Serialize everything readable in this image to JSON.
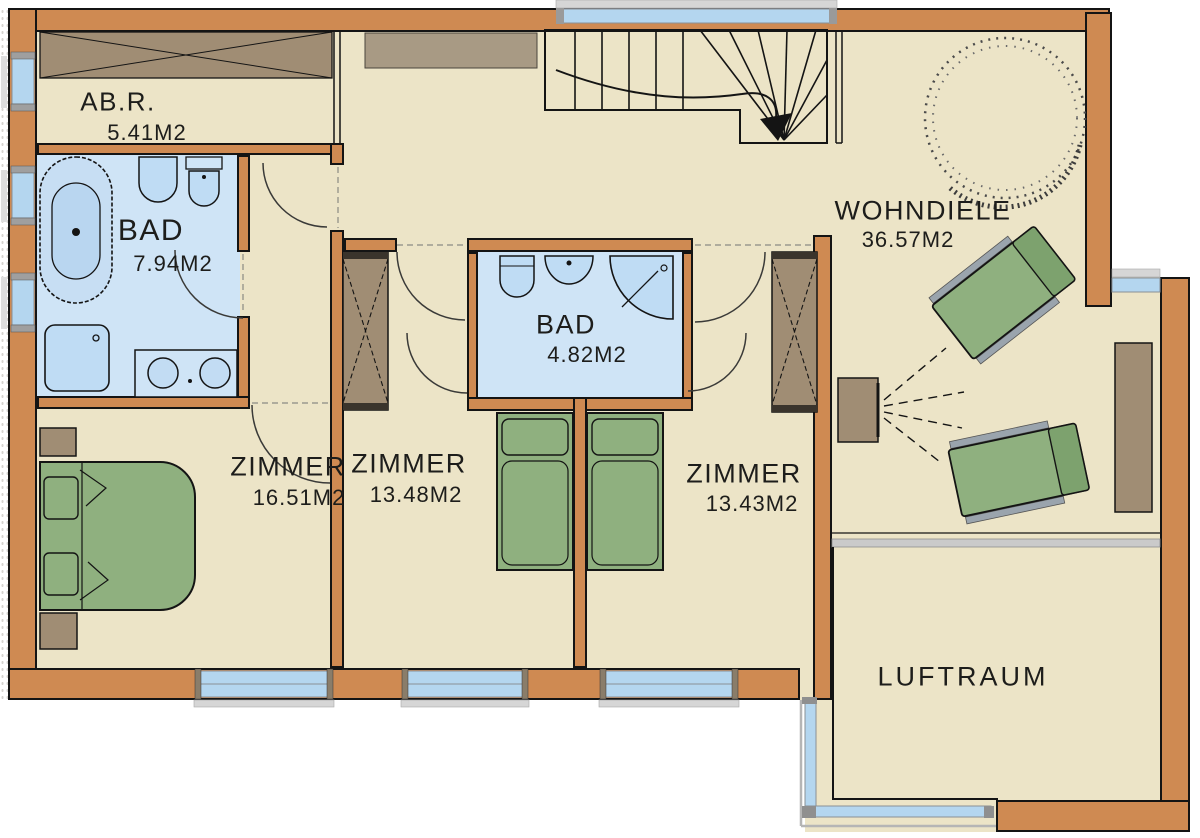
{
  "rooms": {
    "abr": {
      "name": "AB.R.",
      "area": "5.41M2"
    },
    "bad_left": {
      "name": "BAD",
      "area": "7.94M2"
    },
    "bad_middle": {
      "name": "BAD",
      "area": "4.82M2"
    },
    "zimmer_left": {
      "name": "ZIMMER",
      "area": "16.51M2"
    },
    "zimmer_middle": {
      "name": "ZIMMER",
      "area": "13.48M2"
    },
    "zimmer_right": {
      "name": "ZIMMER",
      "area": "13.43M2"
    },
    "wohndiele": {
      "name": "WOHNDIELE",
      "area": "36.57M2"
    },
    "luftraum": {
      "name": "LUFTRAUM"
    }
  },
  "colors": {
    "wall": "#cf8a52",
    "ink": "#141414",
    "floor": "#ece4c7",
    "bath": "#cfe4f6",
    "glass": "#b4d6ef",
    "green": "#8fb07f",
    "green2": "#7da26e",
    "wood": "#a08d74",
    "gray": "#a89a84",
    "white": "#ffffff"
  }
}
